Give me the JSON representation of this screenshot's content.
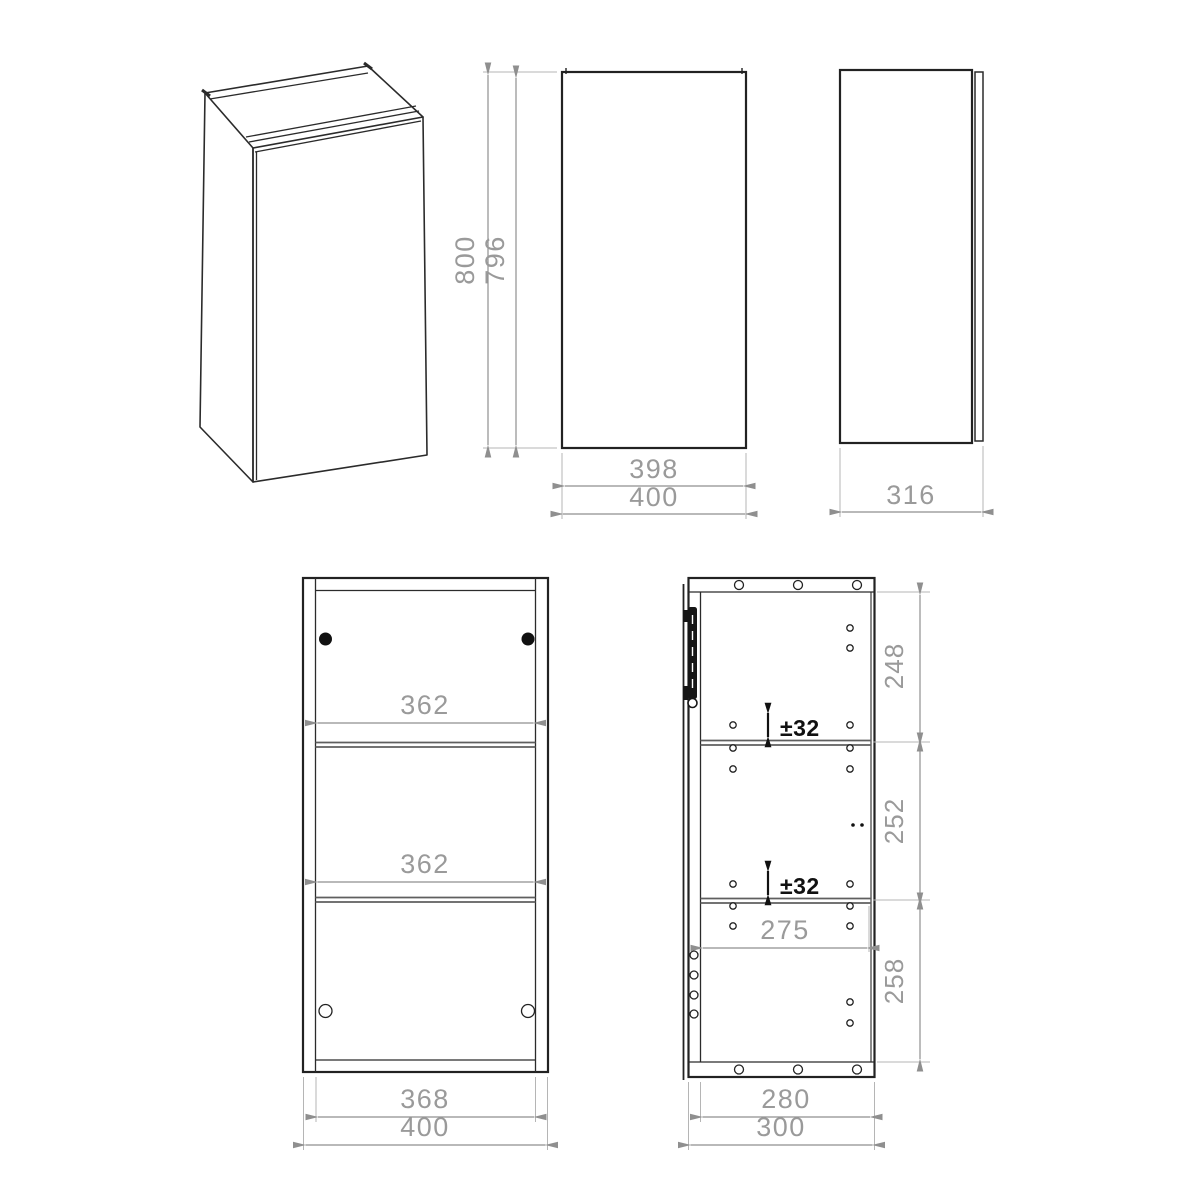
{
  "drawing": {
    "front": {
      "height_total": "800",
      "height_carcass": "796",
      "width_door": "398",
      "width_total": "400"
    },
    "side": {
      "depth_total": "316"
    },
    "front_section": {
      "shelf_top_width": "362",
      "shelf_bottom_width": "362",
      "width_inner": "368",
      "width_total": "400"
    },
    "side_section": {
      "seg_top": "248",
      "seg_mid": "252",
      "seg_bottom": "258",
      "adjust_top": "±32",
      "adjust_bottom": "±32",
      "shelf_depth": "275",
      "depth_inner": "280",
      "depth_total": "300"
    }
  }
}
